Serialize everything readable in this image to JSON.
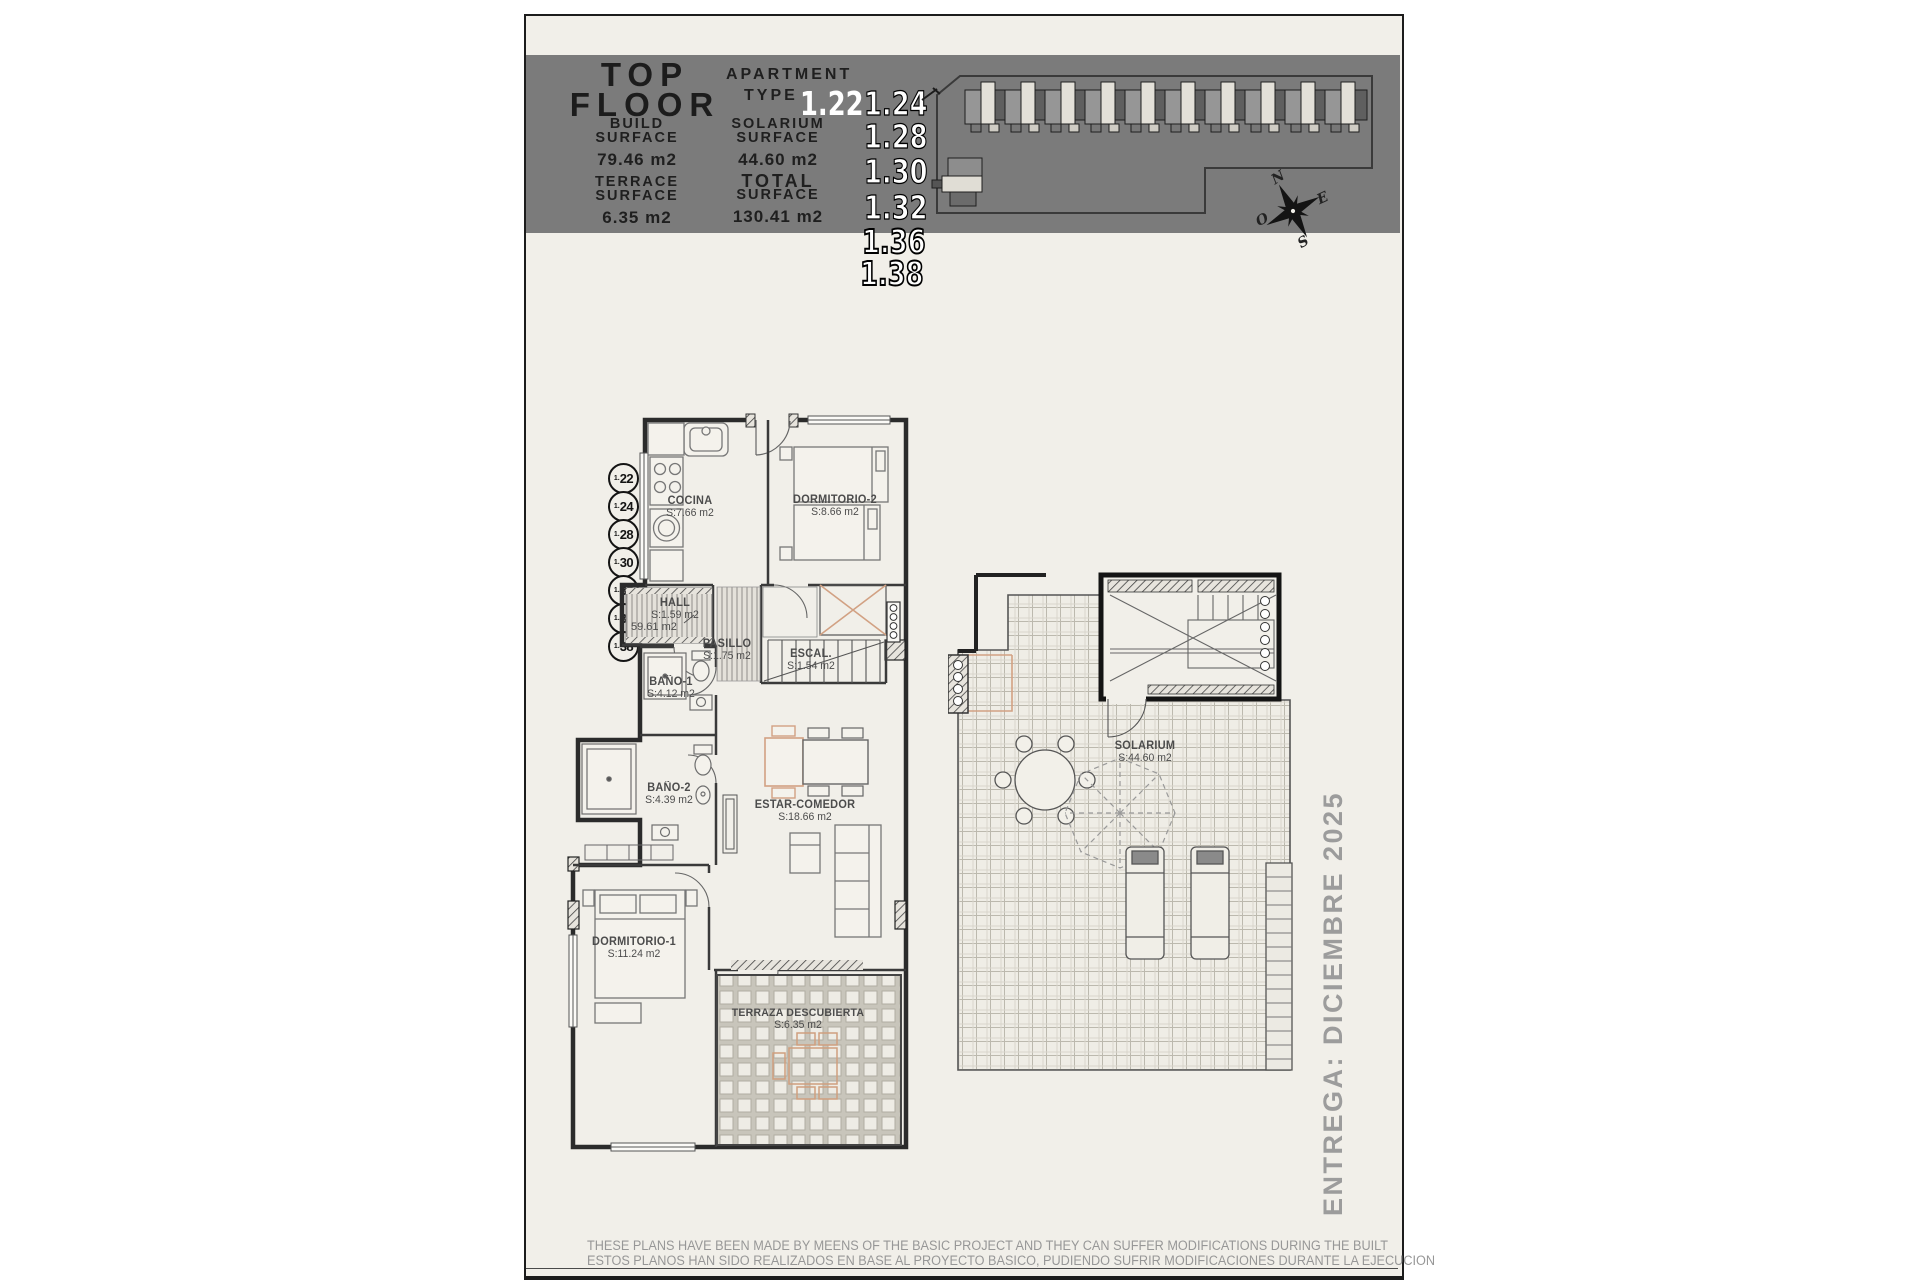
{
  "header": {
    "title_line1": "TOP",
    "title_line2": "FLOOR",
    "apartment_label_1": "APARTMENT",
    "apartment_label_2": "TYPE",
    "type_numbers": {
      "n22": "1.22",
      "n24": "1.24",
      "n28": "1.28",
      "n30": "1.30",
      "n32": "1.32",
      "n36": "1.36",
      "n38": "1.38"
    },
    "build": {
      "l1": "BUILD",
      "l2": "SURFACE",
      "value": "79.46 m2"
    },
    "solarium": {
      "l1": "SOLARIUM",
      "l2": "SURFACE",
      "value": "44.60 m2"
    },
    "terrace": {
      "l1": "TERRACE",
      "l2": "SURFACE",
      "value": "6.35 m2"
    },
    "total": {
      "l1": "TOTAL",
      "l2": "SURFACE",
      "value": "130.41 m2"
    },
    "band_color": "#7b7b7b"
  },
  "compass": {
    "n": "N",
    "e": "E",
    "s": "S",
    "w": "O"
  },
  "unit_badges": [
    {
      "prefix": "1.",
      "num": "22"
    },
    {
      "prefix": "1.",
      "num": "24"
    },
    {
      "prefix": "1.",
      "num": "28"
    },
    {
      "prefix": "1.",
      "num": "30"
    },
    {
      "prefix": "1.",
      "num": "32"
    },
    {
      "prefix": "1.",
      "num": "36"
    },
    {
      "prefix": "1.",
      "num": "38"
    }
  ],
  "rooms": {
    "cocina": {
      "name": "COCINA",
      "area": "S:7.66 m2"
    },
    "dormitorio2": {
      "name": "DORMITORIO-2",
      "area": "S:8.66 m2"
    },
    "hall": {
      "name": "HALL",
      "area": "S:1.59 m2",
      "extra": "59.61 m2"
    },
    "pasillo": {
      "name": "PASILLO",
      "area": "S:1.75 m2"
    },
    "escalera": {
      "name": "ESCAL.",
      "area": "S:1.54 m2"
    },
    "bano1": {
      "name": "BAÑO-1",
      "area": "S:4.12 m2"
    },
    "bano2": {
      "name": "BAÑO-2",
      "area": "S:4.39 m2"
    },
    "estar": {
      "name": "ESTAR-COMEDOR",
      "area": "S:18.66 m2"
    },
    "dormitorio1": {
      "name": "DORMITORIO-1",
      "area": "S:11.24 m2"
    },
    "terraza": {
      "name": "TERRAZA DESCUBIERTA",
      "area": "S:6.35 m2"
    },
    "solarium": {
      "name": "SOLARIUM",
      "area": "S:44.60 m2"
    }
  },
  "sidebar_note": "ENTREGA: DICIEMBRE 2025",
  "footer": {
    "line1": "THESE PLANS HAVE BEEN MADE BY MEENS OF THE BASIC PROJECT AND THEY CAN SUFFER MODIFICATIONS DURING THE BUILT",
    "line2": "ESTOS PLANOS HAN SIDO REALIZADOS EN BASE AL PROYECTO BASICO, PUDIENDO SUFRIR MODIFICACIONES DURANTE LA EJECUCION"
  },
  "accent_colors": {
    "terracotta": "#d2a183",
    "wall": "#2b2b2b",
    "paper": "#f1efe9"
  }
}
